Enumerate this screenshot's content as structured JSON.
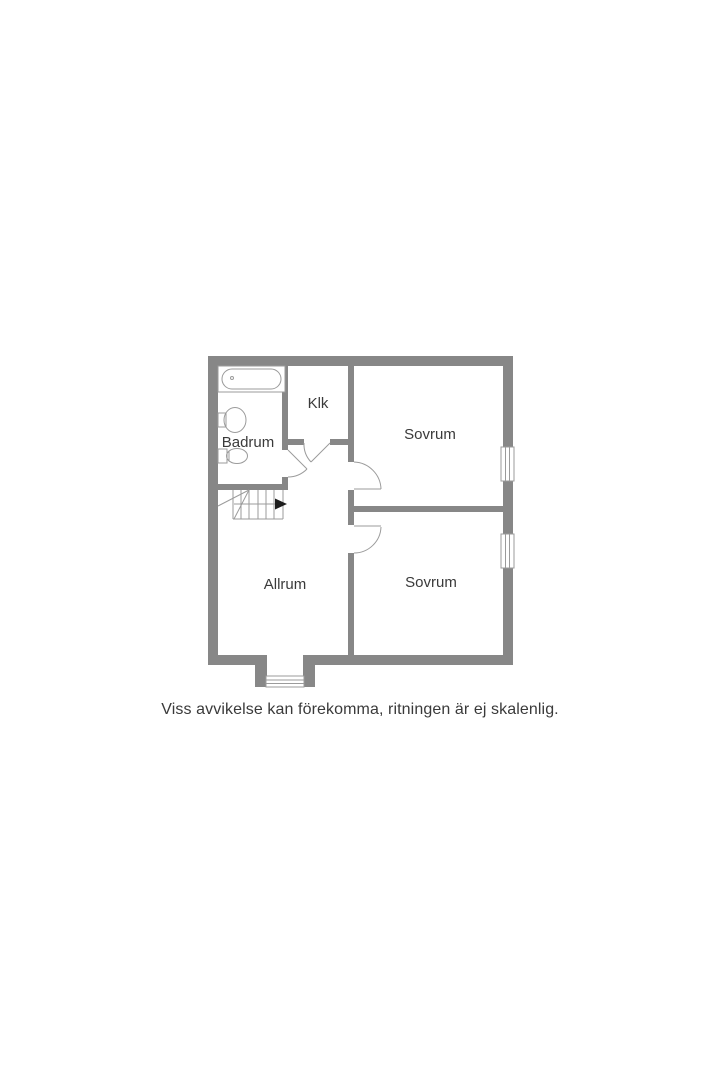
{
  "colors": {
    "background": "#ffffff",
    "wall": "#878787",
    "line": "#9b9b9b",
    "text": "#3a3a3a",
    "arrow": "#1d1d1d"
  },
  "floorplan": {
    "type": "floor-plan",
    "rooms": [
      {
        "id": "badrum",
        "label": "Badrum",
        "fixtures": [
          "bathtub-icon",
          "sink-icon",
          "toilet-icon"
        ]
      },
      {
        "id": "klk",
        "label": "Klk",
        "fixtures": []
      },
      {
        "id": "sovrum-1",
        "label": "Sovrum",
        "fixtures": [
          "window"
        ]
      },
      {
        "id": "allrum",
        "label": "Allrum",
        "fixtures": [
          "stairs-icon",
          "entrance-window"
        ]
      },
      {
        "id": "sovrum-2",
        "label": "Sovrum",
        "fixtures": [
          "window"
        ]
      }
    ],
    "stairs": {
      "direction_arrow": "right"
    },
    "door_count": 4,
    "window_count": 3
  },
  "disclaimer": "Viss avvikelse kan förekomma, ritningen är ej skalenlig."
}
